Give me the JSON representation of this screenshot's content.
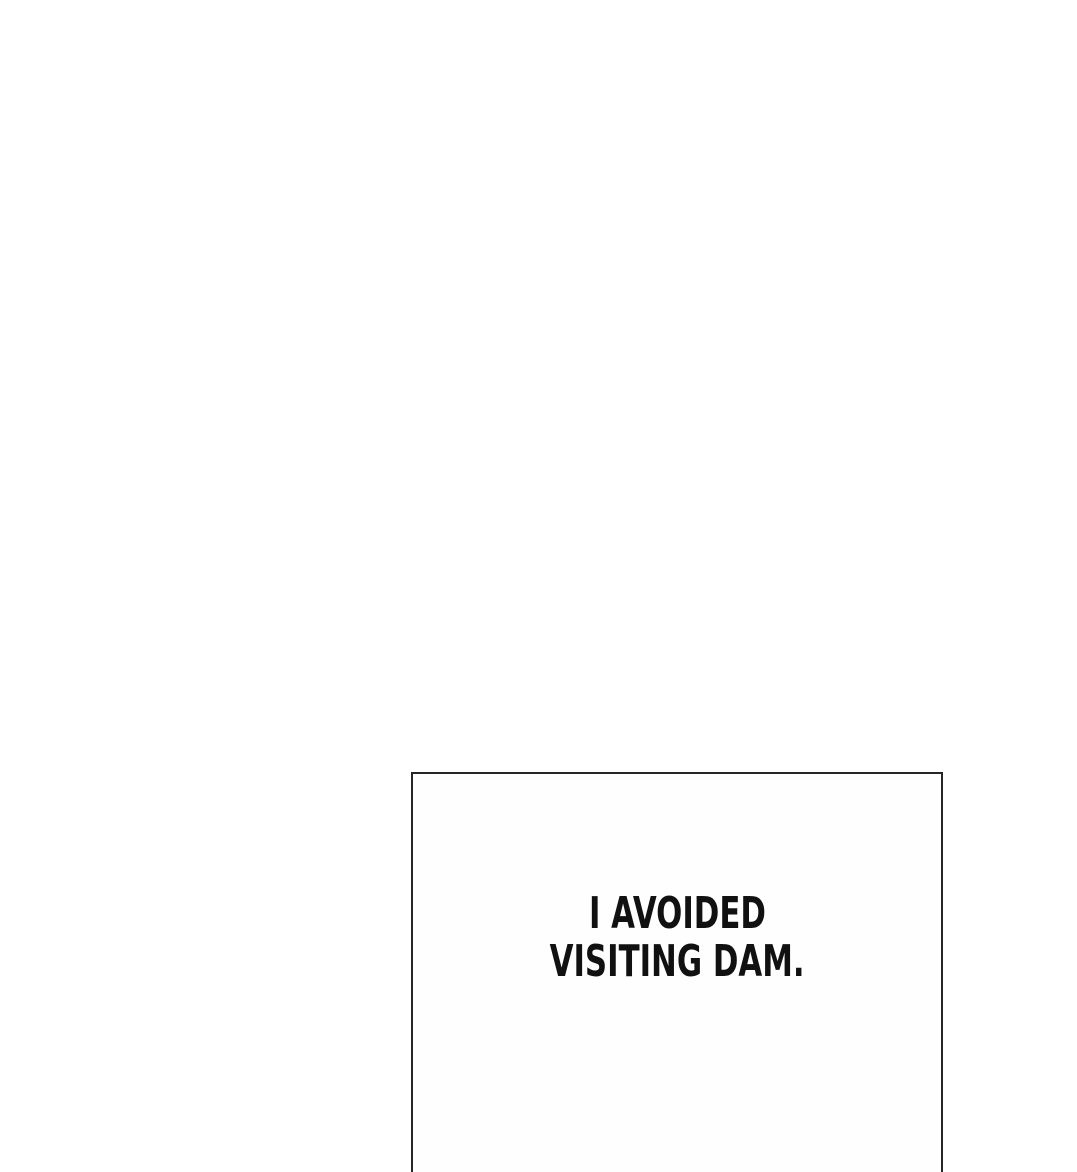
{
  "comic": {
    "panel": {
      "narration_lines": {
        "line1": "I AVOIDED",
        "line2": "VISITING DAM."
      }
    }
  },
  "colors": {
    "page_background": "#ffffff",
    "panel_background": "#fefefe",
    "panel_border": "#262626",
    "narration_text": "#111111"
  }
}
